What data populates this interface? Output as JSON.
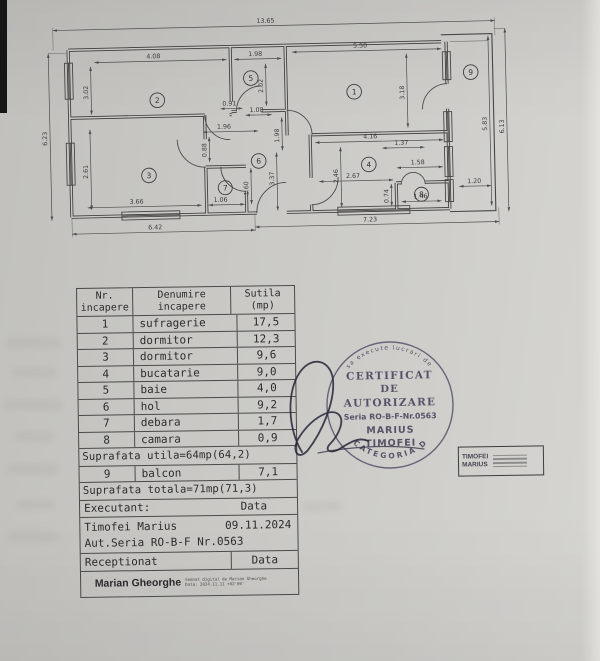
{
  "plan": {
    "labels": {
      "t1365": "13.65",
      "l623": "6.23",
      "r583": "5.83",
      "r613": "6.13",
      "b642": "6.42",
      "b723": "7.23",
      "r2w": "4.08",
      "r2h": "3.02",
      "r5w": "1.98",
      "r5h": "2.02",
      "r1w": "5.50",
      "r1h": "3.18",
      "r3w": "3.66",
      "r3h": "2.61",
      "r7w": "1.06",
      "r7h": "1.60",
      "h196": "1.96",
      "h091": "0.91",
      "h108": "1.08",
      "v088": "0.88",
      "v198": "1.98",
      "v337": "3.37",
      "d137": "1.37",
      "d267": "2.67",
      "r4w": "4.16",
      "r4h": "2.46",
      "r8w": "1.58",
      "r8h": "0.74",
      "d146": "1.46",
      "balc": "1.20"
    },
    "rooms": {
      "n1": "1",
      "n2": "2",
      "n3": "3",
      "n4": "4",
      "n5": "5",
      "n6": "6",
      "n7": "7",
      "n8": "8",
      "n9": "9"
    }
  },
  "table": {
    "header": {
      "c1a": "Nr.",
      "c1b": "incapere",
      "c2a": "Denumire",
      "c2b": "incapere",
      "c3a": "Sutila",
      "c3b": "(mp)"
    },
    "rows": [
      {
        "nr": "1",
        "name": "sufragerie",
        "area": "17,5"
      },
      {
        "nr": "2",
        "name": "dormitor",
        "area": "12,3"
      },
      {
        "nr": "3",
        "name": "dormitor",
        "area": "9,6"
      },
      {
        "nr": "4",
        "name": "bucatarie",
        "area": "9,0"
      },
      {
        "nr": "5",
        "name": "baie",
        "area": "4,0"
      },
      {
        "nr": "6",
        "name": "hol",
        "area": "9,2"
      },
      {
        "nr": "7",
        "name": "debara",
        "area": "1,7"
      },
      {
        "nr": "8",
        "name": "camara",
        "area": "0,9"
      }
    ],
    "subtotal": "Suprafata utila=64mp(64,2)",
    "row9": {
      "nr": "9",
      "name": "balcon",
      "area": "7,1"
    },
    "total": "Suprafata totala=71mp(71,3)",
    "executant_label": "Executant:",
    "data_label": "Data",
    "executant_name": "Timofei Marius",
    "executant_date": "09.11.2024",
    "executant_auth": "Aut.Seria RO-B-F Nr.0563",
    "receptionat_label": "Receptionat",
    "receptionat_data_label": "Data",
    "signature_name": "Marian Gheorghe",
    "signature_note_line1": "Semnat digital de Marian Gheorghe",
    "signature_note_line2": "Data: 2024.11.11 +02'00'"
  },
  "stamp": {
    "ring_top": "sa execute lucrari de",
    "line1": "CERTIFICAT",
    "line2": "DE",
    "line3": "AUTORIZARE",
    "seria": "Seria RO-B-F-Nr.0563",
    "name1": "MARIUS",
    "name2": "TIMOFEI",
    "ring_bottom": "CATEGORIA D"
  },
  "signature_box": {
    "name_line1": "TIMOFEI",
    "name_line2": "MARIUS"
  }
}
